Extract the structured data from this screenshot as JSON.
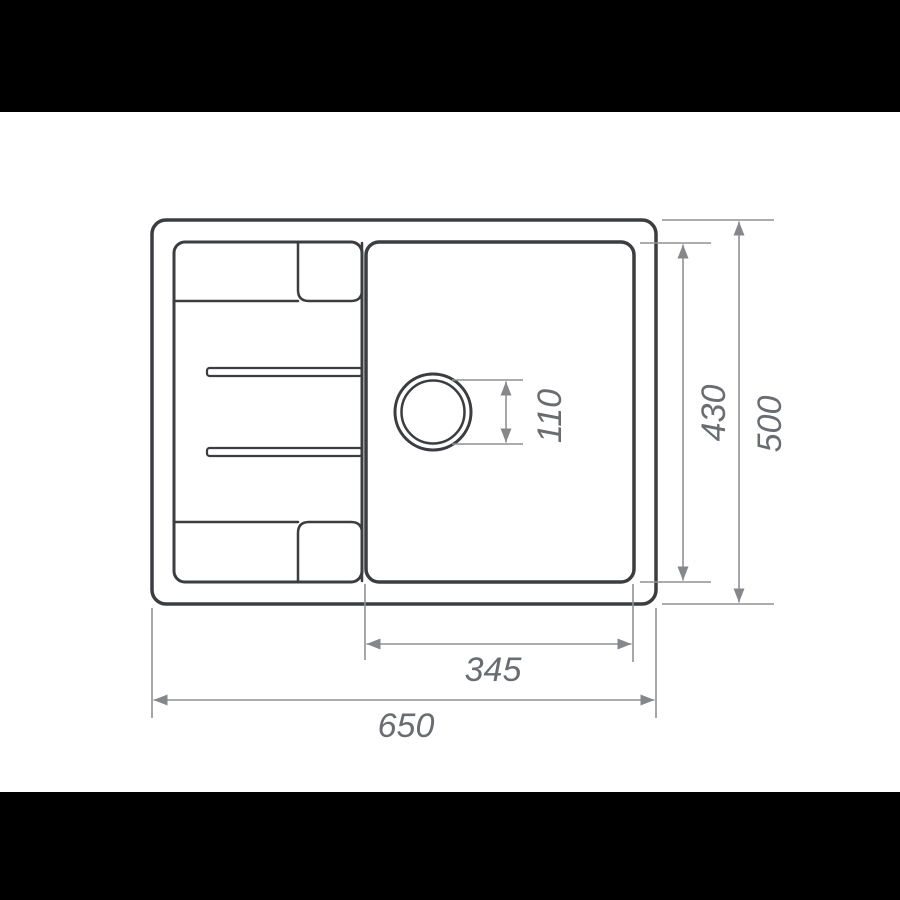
{
  "drawing": {
    "type": "sink-top-view-dimension-drawing",
    "dimension_labels": {
      "overall_width": "650",
      "overall_depth": "500",
      "bowl_width": "345",
      "bowl_depth": "430",
      "drain_diameter": "110"
    }
  },
  "colors": {
    "letterbox": "#000000",
    "sheet": "#ffffff",
    "outline": "#3b3d40",
    "dimension_line": "#8f9194",
    "dimension_arrow": "#85878a",
    "dimension_text": "#696c70"
  }
}
